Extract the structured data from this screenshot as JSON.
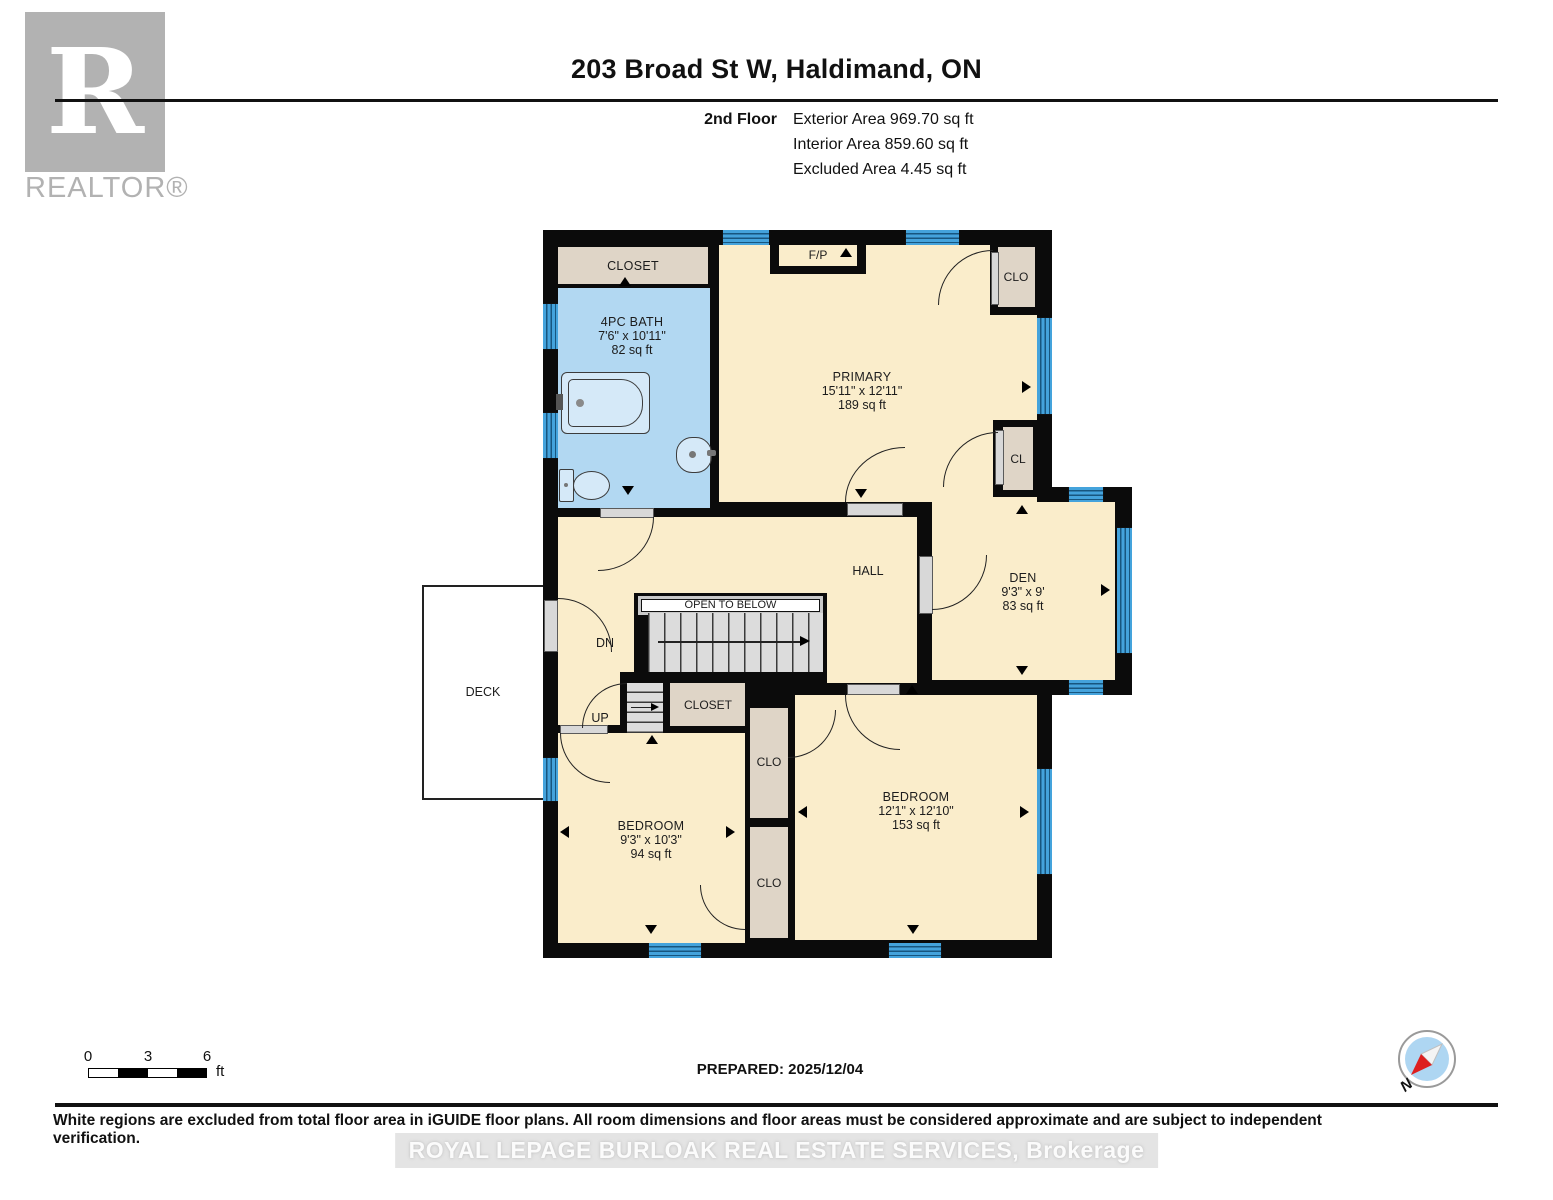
{
  "header": {
    "address": "203 Broad St W, Haldimand, ON",
    "floor": "2nd Floor",
    "areas": [
      "Exterior Area 969.70 sq ft",
      "Interior Area 859.60 sq ft",
      "Excluded Area 4.45 sq ft"
    ]
  },
  "branding": {
    "logo_letter": "R",
    "logo_text": "REALTOR®"
  },
  "floorplan": {
    "rooms": {
      "closet_top": {
        "label": "CLOSET"
      },
      "bath": {
        "label": "4PC BATH",
        "dims": "7'6\" x 10'11\"",
        "area": "82 sq ft"
      },
      "primary": {
        "label": "PRIMARY",
        "dims": "15'11\" x 12'11\"",
        "area": "189 sq ft"
      },
      "fireplace": {
        "label": "F/P"
      },
      "closet_tr": {
        "label": "CLO"
      },
      "closet_r": {
        "label": "CL"
      },
      "hall": {
        "label": "HALL"
      },
      "open_to_below": {
        "label": "OPEN TO BELOW"
      },
      "stairs_down": {
        "label": "DN"
      },
      "stairs_up": {
        "label": "UP"
      },
      "den": {
        "label": "DEN",
        "dims": "9'3\" x 9'",
        "area": "83 sq ft"
      },
      "deck": {
        "label": "DECK"
      },
      "closet_mid": {
        "label": "CLOSET"
      },
      "clo_upper": {
        "label": "CLO"
      },
      "clo_lower": {
        "label": "CLO"
      },
      "bedroom_small": {
        "label": "BEDROOM",
        "dims": "9'3\" x 10'3\"",
        "area": "94 sq ft"
      },
      "bedroom_large": {
        "label": "BEDROOM",
        "dims": "12'1\" x 12'10\"",
        "area": "153 sq ft"
      }
    }
  },
  "scale_bar": {
    "ticks": [
      "0",
      "3",
      "6"
    ],
    "unit": "ft"
  },
  "compass": {
    "north_label": "N"
  },
  "footer": {
    "prepared": "PREPARED: 2025/12/04",
    "disclaimer": "White regions are excluded from total floor area in iGUIDE floor plans. All room dimensions and floor areas must be considered approximate and are subject to independent verification.",
    "watermark": "ROYAL LEPAGE BURLOAK REAL ESTATE SERVICES, Brokerage"
  },
  "colors": {
    "wall": "#0b0b0b",
    "room_fill": "#faedcb",
    "closet_fill": "#dfd5c7",
    "bath_fill": "#b2d8f2",
    "window_blue": "#44a3dc",
    "logo_gray": "#b2b2b2"
  }
}
